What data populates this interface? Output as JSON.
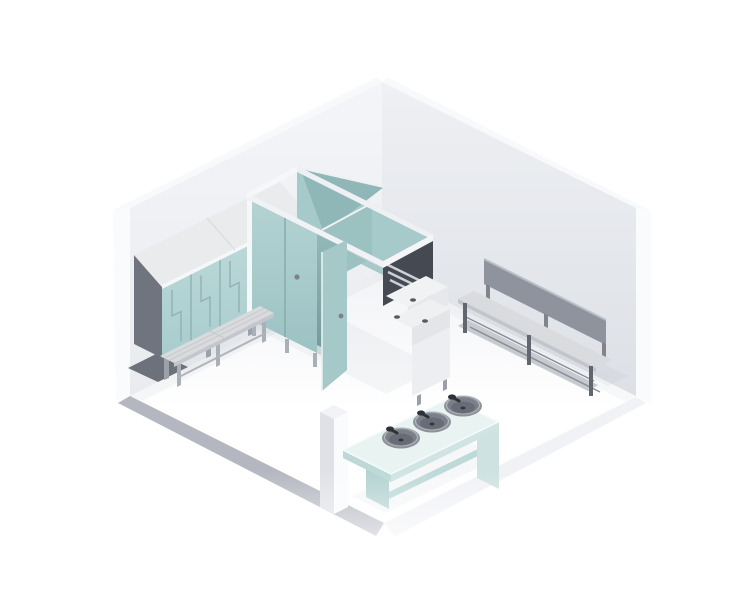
{
  "scene": {
    "title": "Isometric 3D render of a changing room with lockers, sanitary cubicles, benches and a wash trough",
    "room_type": "changing-room"
  },
  "objects": {
    "lockers": {
      "label": "Z-door locker cabinet",
      "door_columns": 5
    },
    "locker_bench": {
      "label": "freestanding cloakroom bench"
    },
    "cubicles": {
      "label": "sanitary cubicle block",
      "closed_doors": 2,
      "open_doors": 1
    },
    "vanity_unit": {
      "label": "duct bench unit with push plates"
    },
    "wall_bench": {
      "label": "bench with backrest and shoe rack"
    },
    "wash_trough": {
      "label": "wash trough",
      "basins": 3
    },
    "step": {
      "label": "floor step ledge"
    }
  },
  "colors": {
    "page_bg": "#ffffff",
    "wall_left_top": "#f4f5f8",
    "wall_left_bottom": "#e9ebef",
    "wall_right_top": "#eef0f3",
    "wall_right_bottom": "#dde0e6",
    "wall_rim": "#f8f9fb",
    "wall_outer": "#fafbfd",
    "floor_back": "#f2f3f6",
    "floor_front": "#ffffff",
    "slab_gray": "#b4b7c0",
    "slab_light": "#f1f2f6",
    "shadow": "#8b93a0",
    "ao": "#aab0ba",
    "locker_front_top": "#c0dbdb",
    "locker_front_bottom": "#a9cccd",
    "locker_seam": "#8fb2b2",
    "locker_side": "#70747f",
    "locker_roof": "#eaebed",
    "locker_roof_edge": "#f6f7f9",
    "locker_leg": "#9ba1a9",
    "locker_mat": "#6d717b",
    "bench_seat": "#d8dadd",
    "bench_seat_edge": "#c3c6cb",
    "bench_slat": "#c6c9cd",
    "bench_leg": "#aab0b7",
    "bench_rail": "#b0b4bb",
    "cub_back": "#a6c9c9",
    "cub_tall": "#8fb7b8",
    "cub_divider": "#9cc1c1",
    "cub_facade_top": "#b4d3d3",
    "cub_facade_bottom": "#9cc2c3",
    "cub_interior_top": "#93b8b8",
    "cub_interior_bottom": "#6f9697",
    "cub_floor_wedge": "#d8e4e4",
    "cub_leaf": "#a5c8c8",
    "cub_rail": "#f1f2f5",
    "cub_rail_left": "#f6f7f9",
    "cub_rail_back": "#eef0f3",
    "cub_rail_right": "#f4f5f8",
    "cub_seam": "#86a9aa",
    "cub_lock": "#7c828b",
    "cub_foot": "#aab0b8",
    "cub_end_dark": "#454a52",
    "cub_chrome": "#cdd1d7",
    "van_top": "#f1f2f4",
    "van_face": "#e6e8eb",
    "van_top2": "#eef0f2",
    "van_face2": "#e3e5e9",
    "van_cabinet": "#eceef1",
    "van_dot": "#565b62",
    "van_leg": "#9aa0a8",
    "wb_backrest": "#8e939d",
    "wb_backrest_top": "#b9bec6",
    "wb_post": "#7f848d",
    "wb_seat": "#d9dbde",
    "wb_seat_edge": "#c2c5cb",
    "wb_leg": "#62666e",
    "wb_shelf": "#c7cacf",
    "wb_rail": "#8a8f98",
    "step_top": "#f2f3f6",
    "step_left": "#dfe1e6",
    "step_right": "#fafbfd",
    "tr_top": "#e9f3f2",
    "tr_rim": "#f8fbfb",
    "tr_edge_left": "#bcd9d8",
    "tr_edge_front": "#cfe4e3",
    "tr_support": "#b3d2d1",
    "tr_support_light": "#cde2e1",
    "tr_stretcher": "#bdd9d8",
    "basin_rim": "#8e939a",
    "basin_bowl": "#798089",
    "basin_shade": "#676d76",
    "basin_drain": "#33373c",
    "basin_hl": "#c6cbd1",
    "faucet": "#2e3237",
    "fade": "#ffffff"
  }
}
